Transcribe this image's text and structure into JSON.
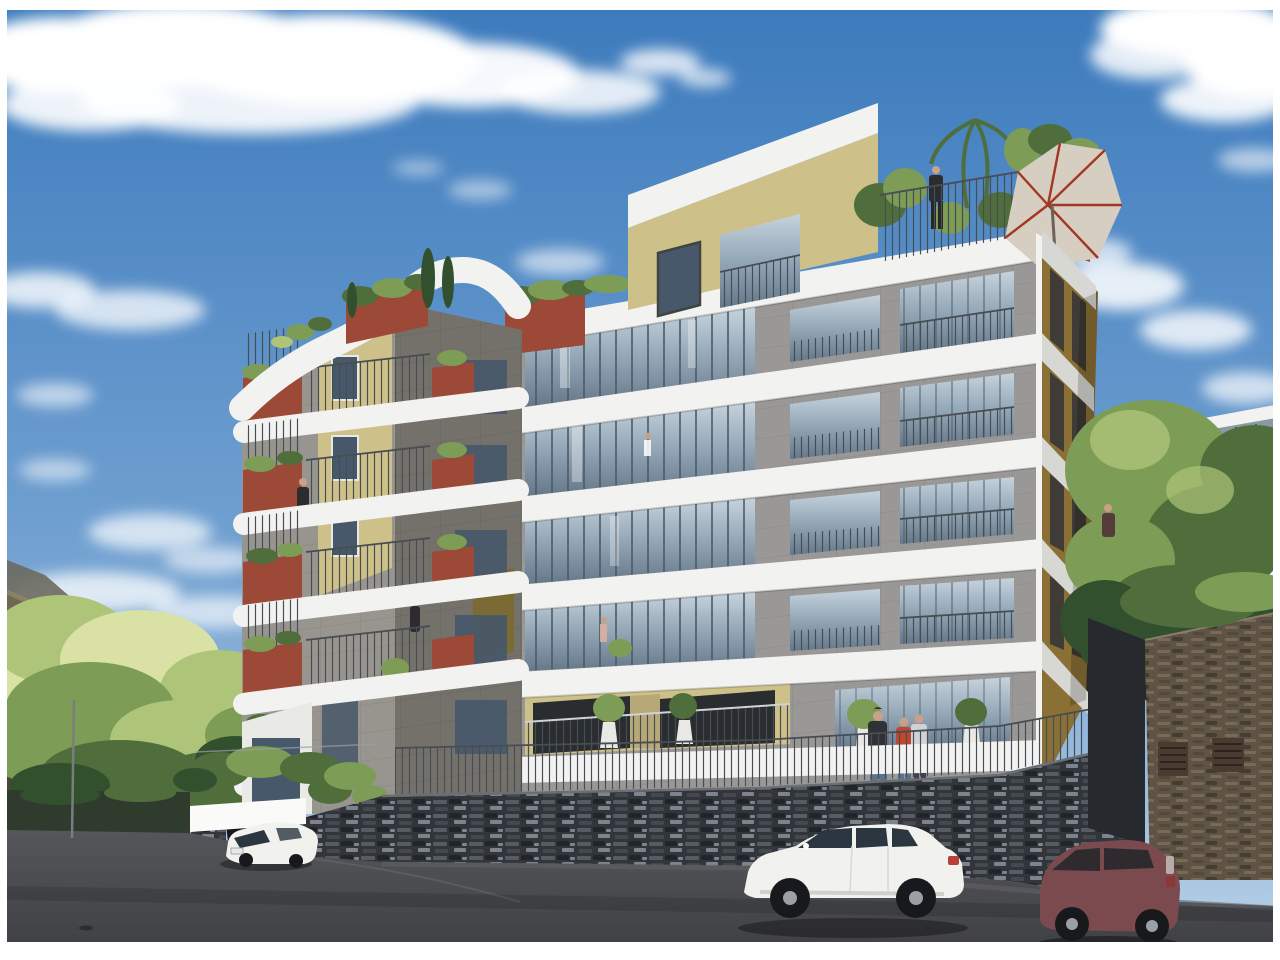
{
  "meta": {
    "type": "architectural-rendering",
    "description": "3D architectural rendering of a modern hillside apartment complex: two connected mid-rise buildings with white floor bands, gray panel facades, tan and rust-red accents, plant-filled balconies and a rooftop terrace with a patio umbrella; a dark stacked-stone retaining wall with a metal railing lines an asphalt street where a white hatchback, a white sedan and a maroon city car are parked; sunlit trees and a mountain ridge rise on the left, leafy trees and a neighboring modern house on the right, under a blue sky with scattered clouds."
  },
  "colors": {
    "frame": "#ffffff",
    "cloud": "#ffffff",
    "skyTop": "#3d7bbd",
    "skyMid": "#6f9fd0",
    "skyLow": "#b5cfe6",
    "bandWhite": "#f2f3f1",
    "bandShade": "#d7d8d4",
    "grayR": "#9a9896",
    "grayRd": "#8b8987",
    "grayL": "#98958f",
    "grayLd": "#74716b",
    "grayDk": "#5f5d58",
    "tan": "#cec089",
    "tanDark": "#b7a878",
    "gold": "#b8953f",
    "goldDark": "#8a7034",
    "olive": "#7a6a33",
    "rust": "#9c4a37",
    "rustDark": "#7c392b",
    "glassTop": "#c6d3dd",
    "glassMid": "#93a7b7",
    "glassBot": "#64788a",
    "glassDark": "#46586a",
    "frameDark": "#3f4442",
    "mullion": "#4e5a64",
    "railing": "#474d52",
    "stoneBG": "#32353a",
    "stoneA": "#575c64",
    "stoneB": "#7e848d",
    "stoneC": "#212428",
    "brownBG": "#5e5344",
    "brownA": "#776b55",
    "brownB": "#463d31",
    "streetTop": "#55565a",
    "streetBot": "#414246",
    "green1": "#d9e2a4",
    "green2": "#aec478",
    "green3": "#7d9c55",
    "green4": "#4f6e3c",
    "green5": "#33502e",
    "mountain": "#4c463c",
    "mountainLit": "#8f8868",
    "mountainFar": "#6b6a5e",
    "carWhite": "#f1f1ee",
    "carShade": "#cfcfcb",
    "carGlass": "#2c3640",
    "maroon": "#7b4a4e",
    "wheel": "#17191c",
    "hub": "#9aa0a5",
    "skin": "#c9a188",
    "shirtRed": "#c0472f",
    "shirtDark": "#2c2c30",
    "jeans": "#5b718c",
    "lightTop": "#cfd2d4",
    "umbrella": "#d6cec0",
    "umbrellaRib": "#a23823"
  },
  "scene": {
    "sky": {
      "condition": "blue sky with scattered white cumulus clouds"
    },
    "buildings": {
      "left_tower": {
        "style": "stacked curved white balcony slabs",
        "facade_colors": [
          "light gray",
          "tan",
          "dark gray"
        ],
        "accents": "rust-red balcony planters with hanging greenery",
        "roof": "cypress trees and shrub planters"
      },
      "right_block": {
        "floors_visible": 6,
        "facade": "gray panel grid with sloping white floor bands and full-height glazing",
        "penthouse": "tan setback level with rooftop terrace",
        "side_facade": "gold pilasters with dark window strips",
        "roof_features": [
          "terrace railing",
          "palms and shrubs",
          "rust planter wall",
          "tilted patio umbrella",
          "person at railing"
        ]
      }
    },
    "street": {
      "surface": "asphalt",
      "wall": "dark stacked-slate retaining wall topped with thin metal railing",
      "garage": "white canopy over parking entrance",
      "outbuilding": "brown stone wall with two louvered vents on the right"
    },
    "vehicles": [
      {
        "type": "hatchback",
        "color": "white",
        "position": "left, at garage driveway"
      },
      {
        "type": "sedan",
        "color": "white",
        "position": "center-right, parked along wall"
      },
      {
        "type": "city-car",
        "color": "maroon",
        "position": "right, parked along wall"
      }
    ],
    "people": [
      {
        "where": "rooftop terrace railing"
      },
      {
        "where": "left tower upper balcony"
      },
      {
        "where": "left tower middle balcony"
      },
      {
        "where": "ground-floor terrace, group of three"
      },
      {
        "where": "hillside walkway on the right"
      }
    ],
    "vegetation": {
      "left": "bright sunlit hillside trees",
      "right": "leafy green trees beside the building",
      "balconies": "potted shrubs, small trees and trailing plants"
    },
    "background": {
      "left": "dark mountain ridge with sunlit crest",
      "right": "modern neighboring house with glass balustrade and vine wall"
    }
  }
}
